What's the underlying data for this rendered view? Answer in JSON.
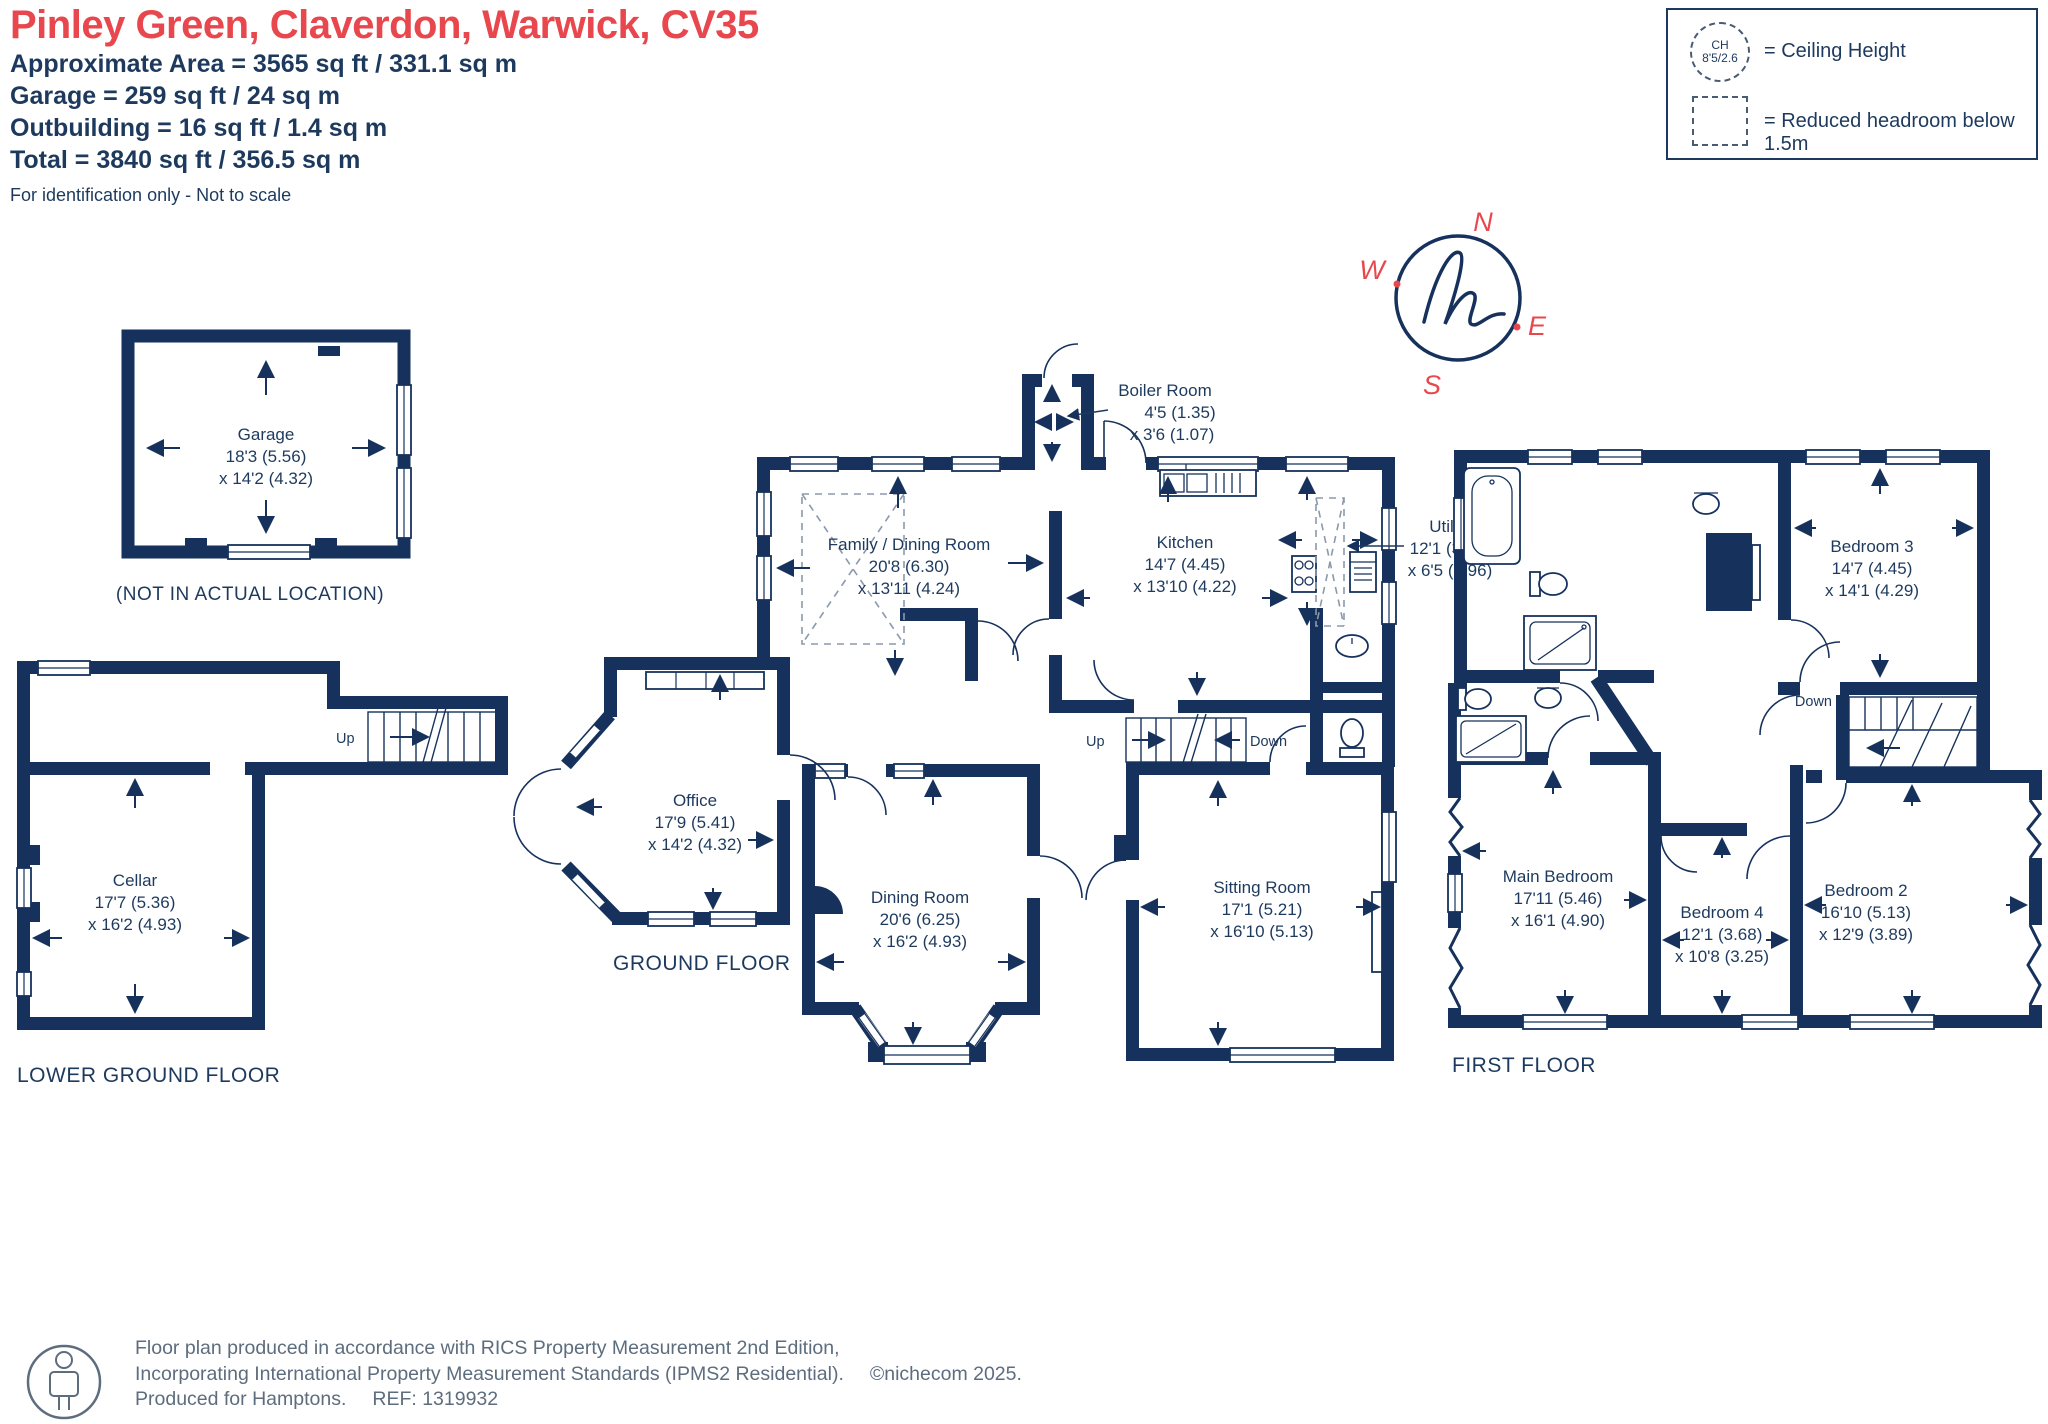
{
  "header": {
    "title": "Pinley Green, Claverdon, Warwick, CV35",
    "line1": "Approximate Area = 3565 sq ft / 331.1 sq m",
    "line2": "Garage = 259 sq ft / 24 sq m",
    "line3": "Outbuilding = 16 sq ft / 1.4 sq m",
    "line4": "Total = 3840 sq ft / 356.5 sq m",
    "disclaimer": "For identification only - Not to scale"
  },
  "legend": {
    "ch_abbr": "CH",
    "ch_value": "8'5/2.6",
    "ceiling": "= Ceiling Height",
    "reduced": "= Reduced headroom below 1.5m"
  },
  "compass": {
    "n": "N",
    "e": "E",
    "s": "S",
    "w": "W"
  },
  "garage": {
    "name": "Garage",
    "dim1": "18'3 (5.56)",
    "dim2": "x 14'2 (4.32)",
    "note": "(NOT IN ACTUAL LOCATION)"
  },
  "lower_ground": {
    "label": "LOWER GROUND FLOOR",
    "up": "Up",
    "cellar": {
      "name": "Cellar",
      "dim1": "17'7 (5.36)",
      "dim2": "x 16'2 (4.93)"
    }
  },
  "ground": {
    "label": "GROUND FLOOR",
    "up": "Up",
    "down": "Down",
    "boiler": {
      "name": "Boiler Room",
      "dim1": "4'5 (1.35)",
      "dim2": "x 3'6 (1.07)"
    },
    "family": {
      "name": "Family / Dining Room",
      "dim1": "20'8 (6.30)",
      "dim2": "x 13'11 (4.24)"
    },
    "kitchen": {
      "name": "Kitchen",
      "dim1": "14'7 (4.45)",
      "dim2": "x 13'10 (4.22)"
    },
    "utility": {
      "name": "Utility",
      "dim1": "12'1 (3.68)",
      "dim2": "x 6'5 (1.96)"
    },
    "office": {
      "name": "Office",
      "dim1": "17'9 (5.41)",
      "dim2": "x 14'2 (4.32)"
    },
    "dining": {
      "name": "Dining Room",
      "dim1": "20'6 (6.25)",
      "dim2": "x 16'2 (4.93)"
    },
    "sitting": {
      "name": "Sitting Room",
      "dim1": "17'1 (5.21)",
      "dim2": "x 16'10 (5.13)"
    }
  },
  "first": {
    "label": "FIRST FLOOR",
    "down": "Down",
    "bed3": {
      "name": "Bedroom 3",
      "dim1": "14'7 (4.45)",
      "dim2": "x 14'1 (4.29)"
    },
    "main": {
      "name": "Main Bedroom",
      "dim1": "17'11 (5.46)",
      "dim2": "x 16'1 (4.90)"
    },
    "bed4": {
      "name": "Bedroom 4",
      "dim1": "12'1 (3.68)",
      "dim2": "x 10'8 (3.25)"
    },
    "bed2": {
      "name": "Bedroom 2",
      "dim1": "16'10 (5.13)",
      "dim2": "x 12'9 (3.89)"
    }
  },
  "footer": {
    "line1": "Floor plan produced in accordance with RICS Property Measurement 2nd Edition,",
    "line2": "Incorporating International Property Measurement Standards (IPMS2 Residential).",
    "copyright": "©nichecom 2025.",
    "line3": "Produced for Hamptons.",
    "ref": "REF:  1319932"
  },
  "colors": {
    "wall": "#16325c",
    "text": "#1d3a5e",
    "accent": "#e8484d"
  }
}
